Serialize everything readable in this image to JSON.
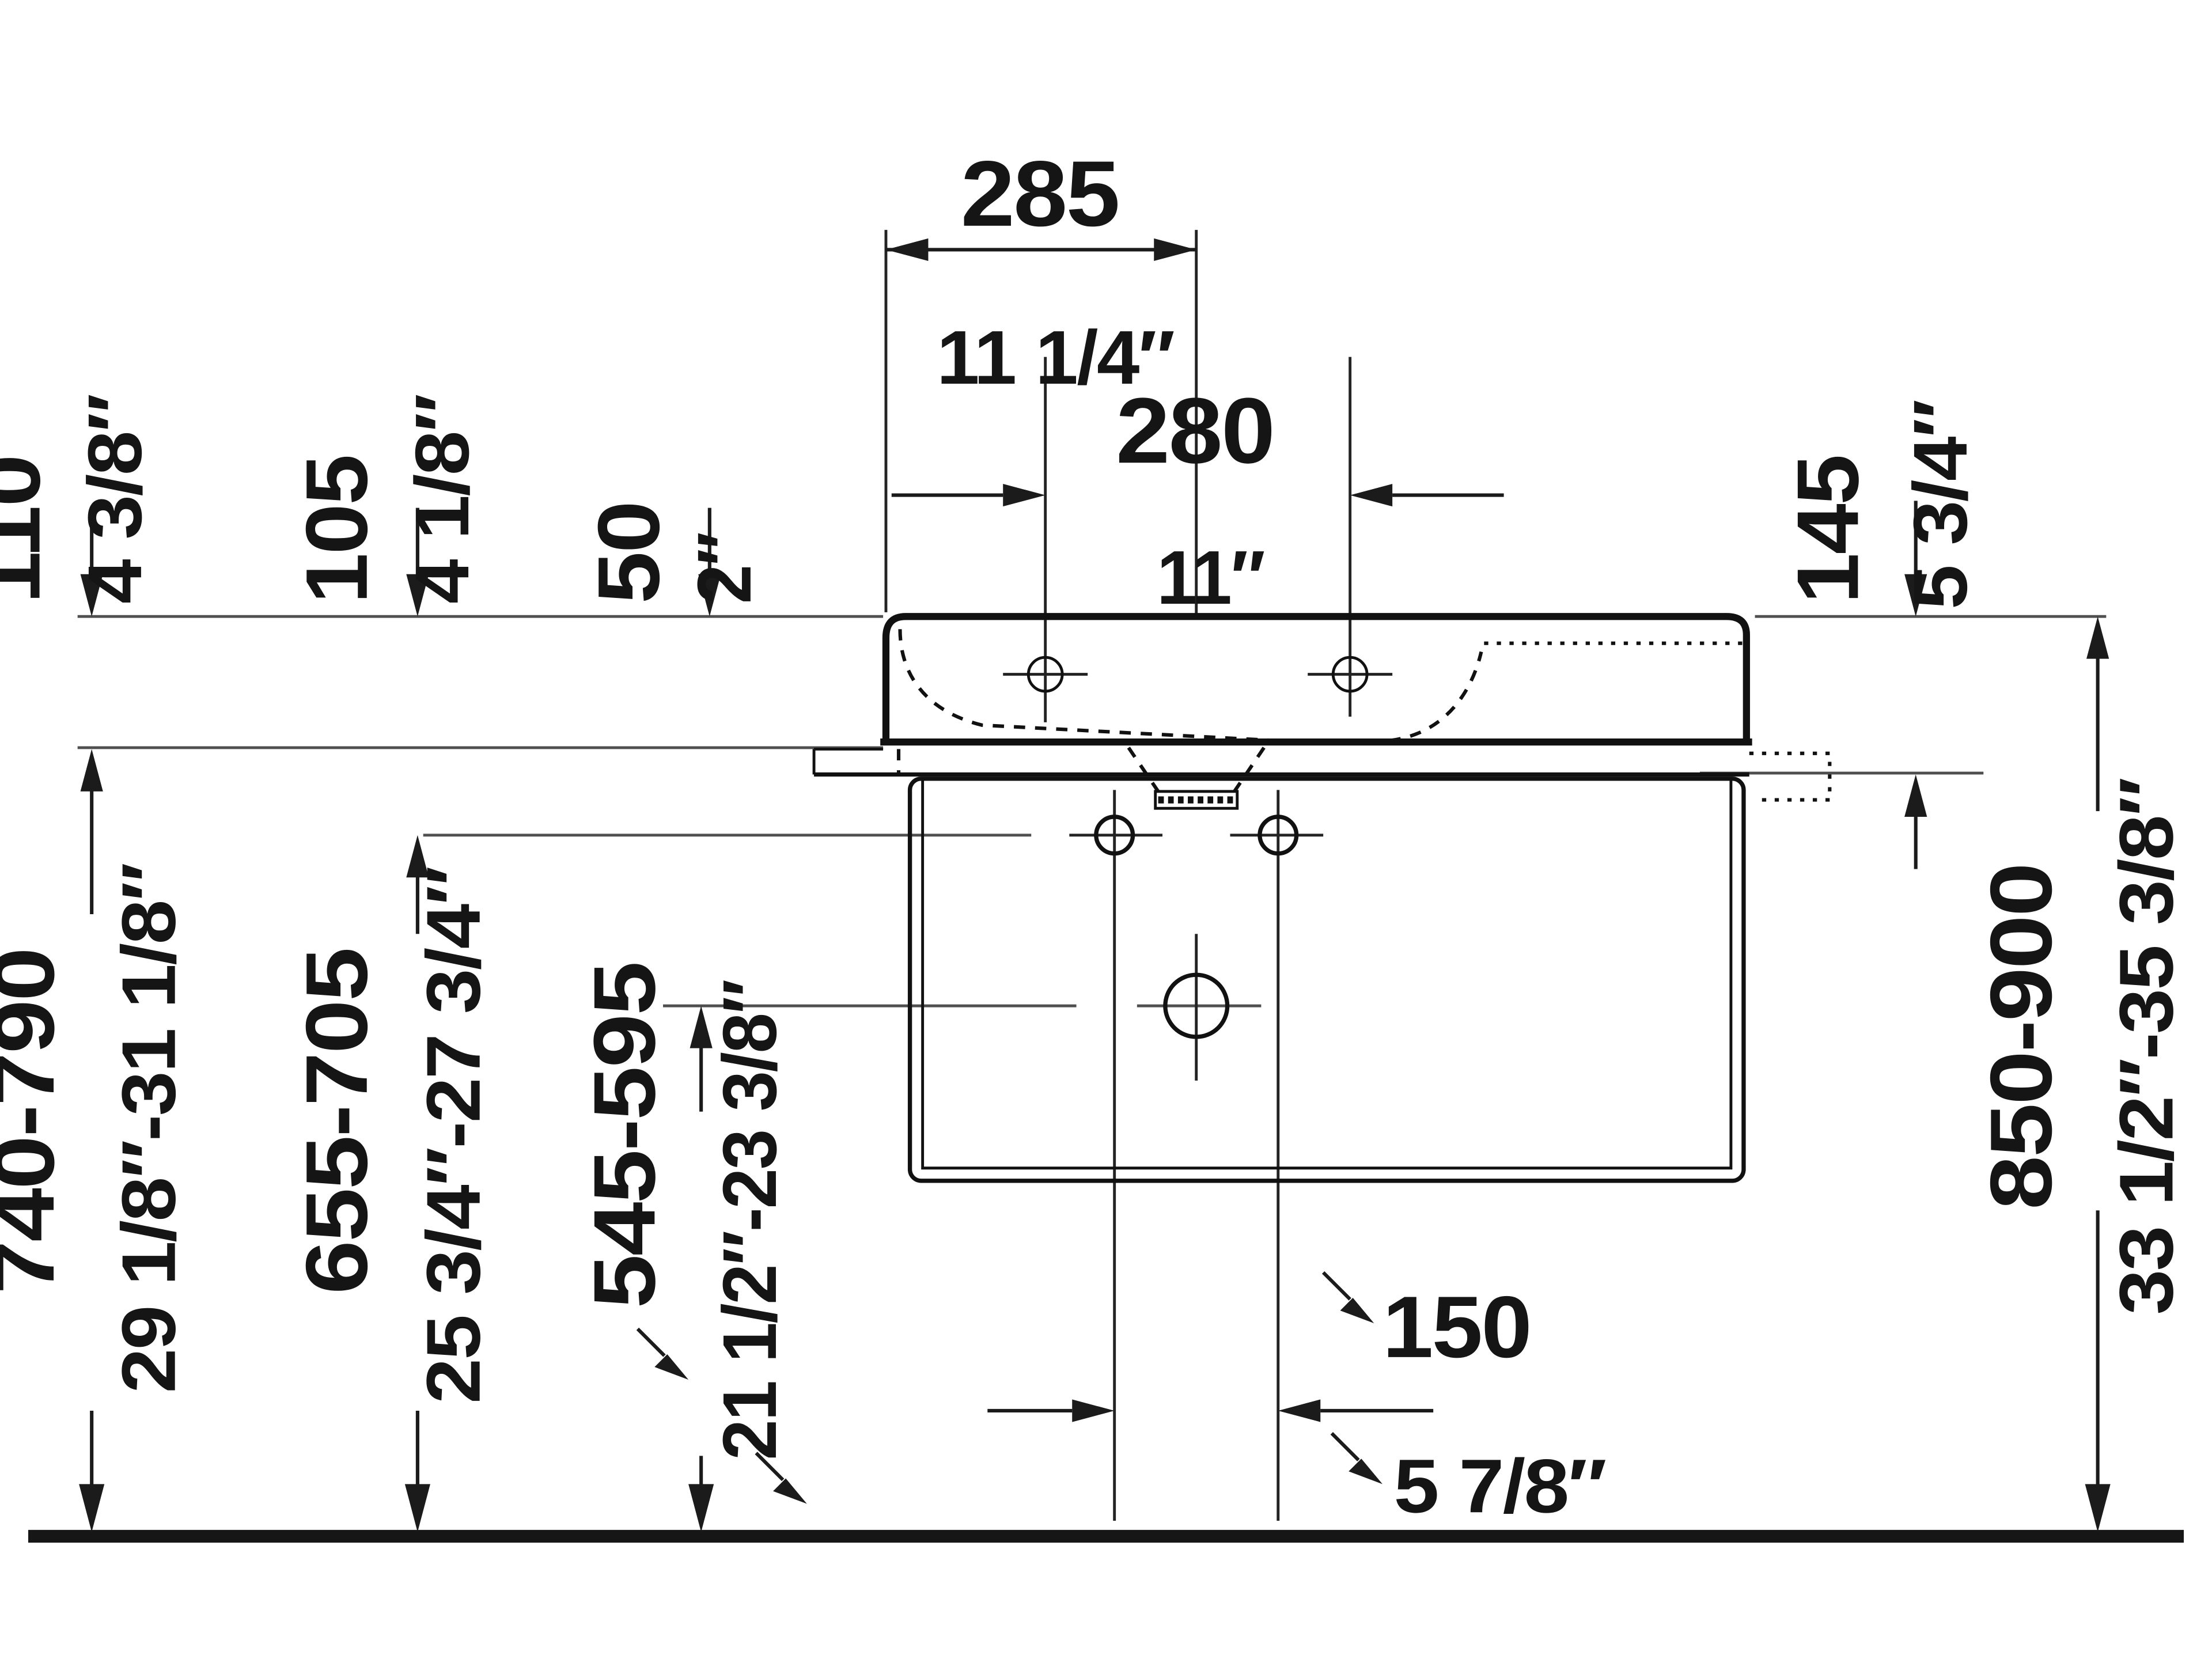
{
  "drawing": {
    "type": "technical-dimension-diagram",
    "subject": "wall-mounted washbasin with console frame, side elevation",
    "units": [
      "mm",
      "inch"
    ],
    "colors": {
      "background": "#ffffff",
      "line": "#111111",
      "reference_line": "#4f4f4f",
      "text": "#151515"
    },
    "labels": {
      "d285_mm": "285",
      "d285_in": "11 1/4″",
      "d280_mm": "280",
      "d280_in": "11″",
      "d110_mm": "110",
      "d110_in": "4 3/8″",
      "d105_mm": "105",
      "d105_in": "4 1/8″",
      "d50_mm": "50",
      "d50_in": "2″",
      "d145_mm": "145",
      "d145_in": "5 3/4″",
      "d740_mm": "740-790",
      "d740_in": "29 1/8″-31 1/8″",
      "d655_mm": "655-705",
      "d655_in": "25 3/4″-27 3/4″",
      "d545_mm": "545-595",
      "d545_in": "21 1/2″-23 3/8″",
      "d850_mm": "850-900",
      "d850_in": "33 1/2″-35 3/8″",
      "d150_mm": "150",
      "d150_in": "5 7/8″"
    }
  }
}
